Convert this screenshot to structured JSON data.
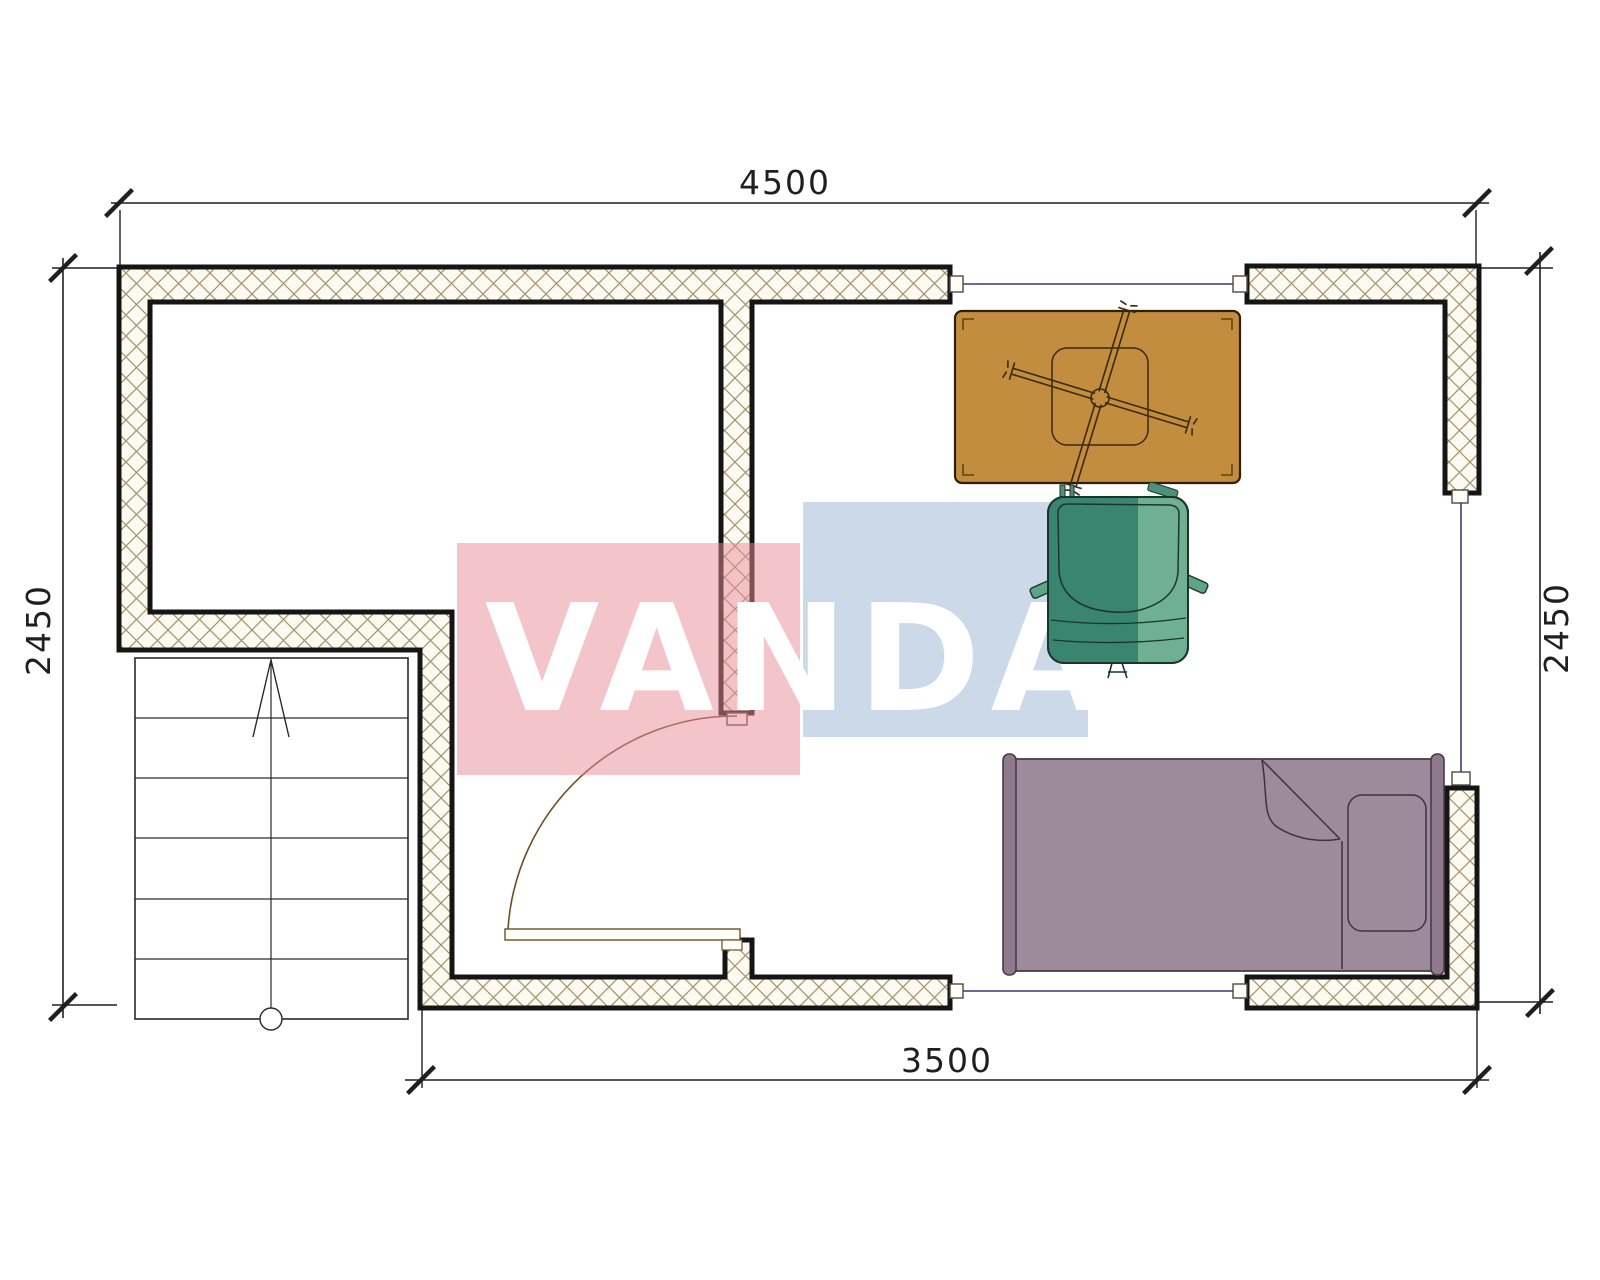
{
  "drawing": {
    "type": "architectural-floor-plan",
    "watermark": {
      "text": "VANDA",
      "pink_color": "rgba(233,138,152,0.50)",
      "blue_color": "rgba(160,186,214,0.55)",
      "letter_color": "#ffffff"
    },
    "dimensions": {
      "top": "4500",
      "bottom": "3500",
      "left": "2450",
      "right": "2450"
    },
    "colors": {
      "wall_fill": "#fdfbf1",
      "wall_hatch": "#a5916b",
      "wall_stroke": "#151515",
      "window_line": "#3a3a72",
      "cap_fill": "#fffef6",
      "door_line": "#6d4f26",
      "stair_line": "#2a2a2a",
      "table_fill": "#c28d3e",
      "table_stroke": "#2e2008",
      "chair_dark": "#3a8570",
      "chair_mid": "#5ea487",
      "chair_light": "#6fb092",
      "bed_fill": "#9d8a9a",
      "bed_bar": "#8e7a8c",
      "bed_stroke": "#4a3c49",
      "dimension_color": "#1f1f1f"
    },
    "elements": {
      "stairs": "staircase with up arrow",
      "door": "quarter-circle swing door",
      "windows": "3 window openings with jamb caps",
      "table": "table with swivel chair base",
      "armchair": "teal armchair",
      "bed": "single bed with pillow"
    }
  }
}
